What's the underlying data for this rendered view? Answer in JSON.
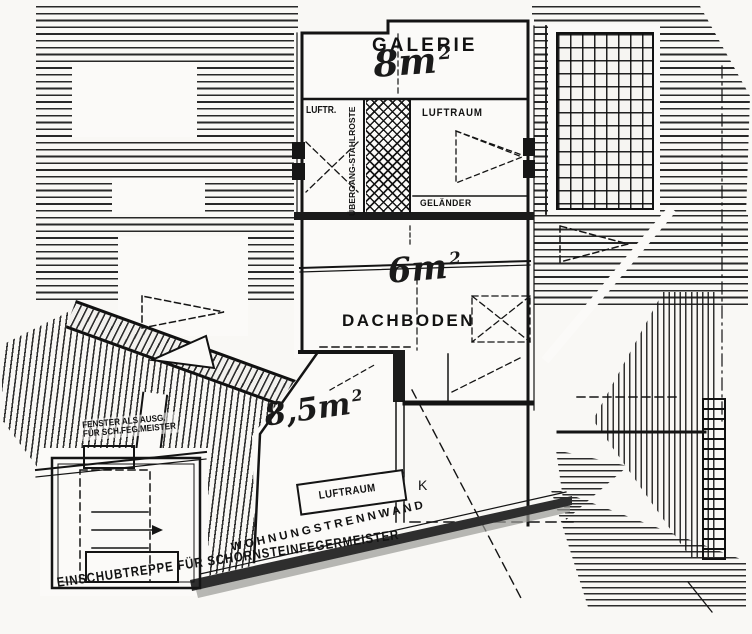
{
  "document": {
    "type": "scanned attic floor plan",
    "language": "German"
  },
  "labels": {
    "galerie": "GALERIE",
    "galerie_area": "8m",
    "galerie_area_sup": "2",
    "luftraum_left": "LUFTR.",
    "uebergang_stahlroste": "ÜBERGANG-STAHLROSTE",
    "luftraum_right": "LUFTRAUM",
    "gelaender": "GELÄNDER",
    "dachboden_area": "6m",
    "dachboden_area_sup": "2",
    "dachboden": "DACHBODEN",
    "room_area": "8,5m",
    "room_area_sup": "2",
    "luftraum_bottom": "LUFTRAUM",
    "wohnungstrennwand": "WOHNUNGSTRENNWAND",
    "einschubtreppe": "EINSCHUBTREPPE FÜR SCHORNSTEINFEGERMEISTER",
    "fenster_line1": "FENSTER ALS AUSG.",
    "fenster_line2": "FÜR SCH.FEG.MEISTER",
    "k_mark": "K"
  },
  "colors": {
    "ink": "#141414",
    "paper": "#f9f8f5",
    "wall_fill": "#2e2e2e"
  }
}
